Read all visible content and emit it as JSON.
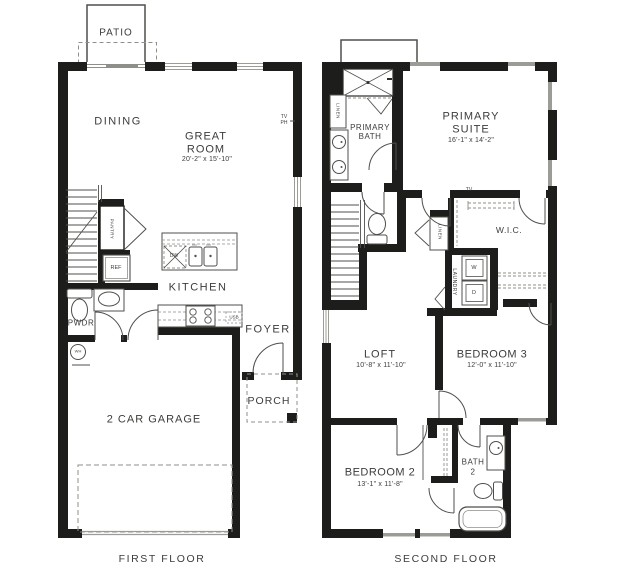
{
  "palette": {
    "wall": "#1d1d1b",
    "line": "#4f4f4b",
    "line_light": "#8f8f8a",
    "window": "#9c9c97",
    "text": "#3c3c3a",
    "background": "#ffffff"
  },
  "first_floor": {
    "caption": "FIRST FLOOR",
    "rooms": {
      "patio": "PATIO",
      "dining": "DINING",
      "great_room": "GREAT ROOM",
      "great_room_dims": "20'-2\" x 15'-10\"",
      "kitchen": "KITCHEN",
      "pwdr": "PWDR",
      "foyer": "FOYER",
      "porch": "PORCH",
      "garage": "2 CAR GARAGE"
    },
    "fixtures": {
      "tv": "TV",
      "ph": "PH",
      "pantry": "PANTRY",
      "ref": "REF",
      "dw": "DW",
      "usb": "USB",
      "wh": "WH"
    }
  },
  "second_floor": {
    "caption": "SECOND FLOOR",
    "rooms": {
      "primary_suite": "PRIMARY SUITE",
      "primary_suite_dims": "16'-1\" x 14'-2\"",
      "primary_bath": "PRIMARY BATH",
      "wic": "W.I.C.",
      "loft": "LOFT",
      "loft_dims": "10'-8\" x 11'-10\"",
      "bedroom3": "BEDROOM 3",
      "bedroom3_dims": "12'-0\" x 11'-10\"",
      "bedroom2": "BEDROOM 2",
      "bedroom2_dims": "13'-1\" x 11'-8\"",
      "bath2_line1": "BATH",
      "bath2_line2": "2"
    },
    "fixtures": {
      "linen1": "LINEN",
      "linen2": "LINEN",
      "laundry": "LAUNDRY",
      "washer": "W",
      "dryer": "D",
      "tv": "TV"
    }
  }
}
